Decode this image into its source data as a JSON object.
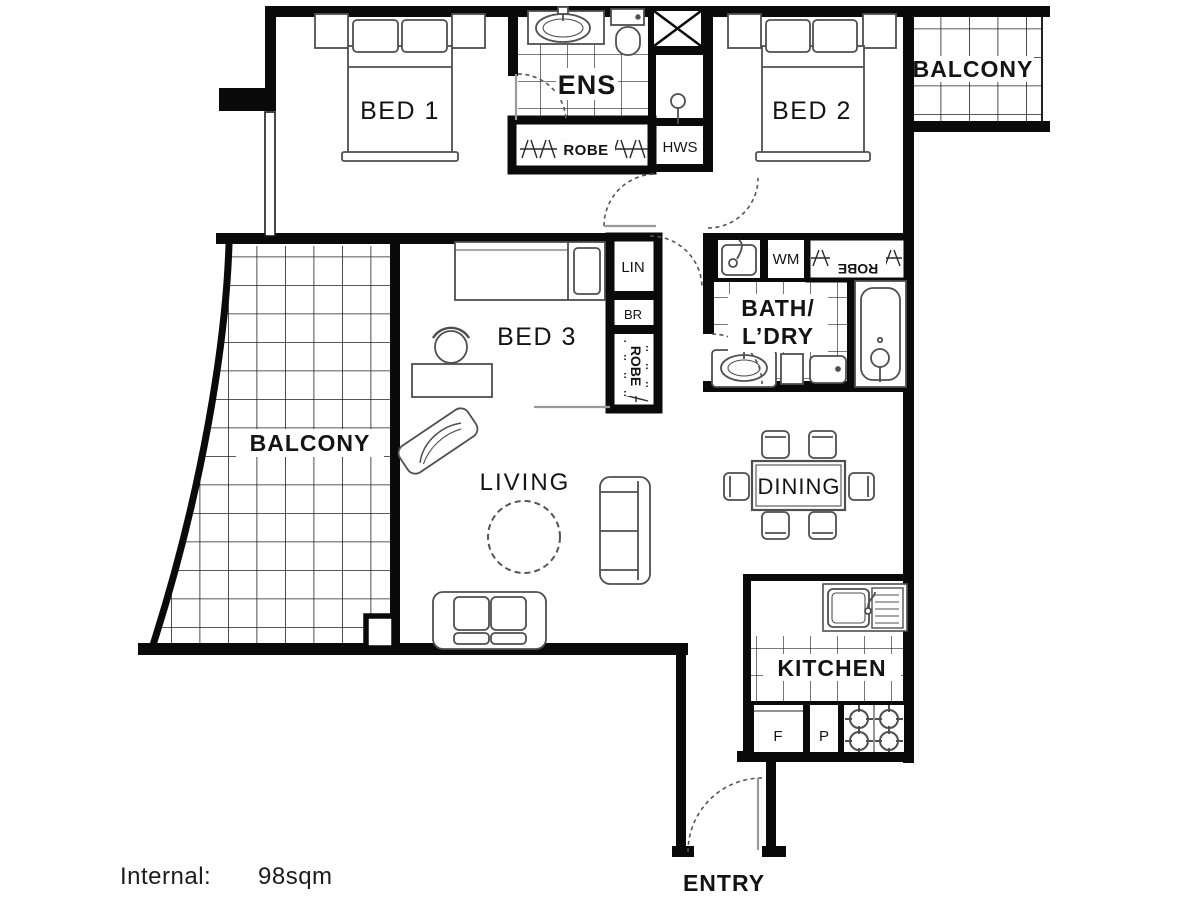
{
  "title": "Apartment floor plan",
  "rooms": {
    "bed1": "BED 1",
    "bed2": "BED 2",
    "bed3": "BED 3",
    "ens": "ENS",
    "robe_ens": "ROBE",
    "hws": "HWS",
    "balcony_right": "BALCONY",
    "balcony_left": "BALCONY",
    "lin": "LIN",
    "br": "BR",
    "robe_bed3": "ROBE",
    "wm": "WM",
    "robe_bed2": "ROBE",
    "bath_line1": "BATH/",
    "bath_line2": "L’DRY",
    "living": "LIVING",
    "dining": "DINING",
    "kitchen": "KITCHEN",
    "fridge": "F",
    "pantry": "P",
    "entry": "ENTRY"
  },
  "footer": {
    "label": "Internal:",
    "value": "98sqm"
  },
  "colors": {
    "wall": "#0a0a0a",
    "furniture": "#4f4f4f",
    "tile": "#262626",
    "background": "#ffffff"
  }
}
